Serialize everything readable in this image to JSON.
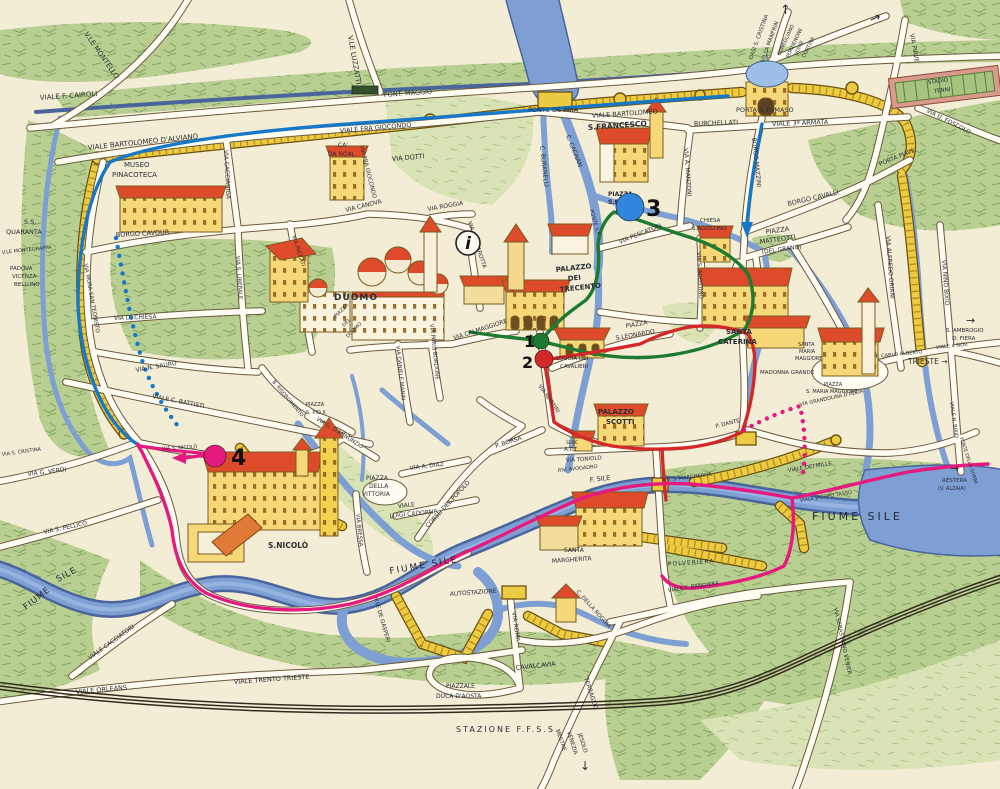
{
  "palette": {
    "paper": "#f3edd5",
    "water": "#7d9fd3",
    "water_dark": "#49659c",
    "green": "#b9cf92",
    "green_dark": "#5d8a3f",
    "wall_gold": "#ecca42",
    "wall_edge": "#6b500f",
    "road_fill": "#fffdf2",
    "road_edge": "#6a5a40",
    "building": "#f6d879",
    "roof_red": "#dd4b2b",
    "ink": "#2a2d33",
    "route_blue": "#1878c8",
    "route_green": "#1e7a30",
    "route_red": "#d42828",
    "route_pink": "#e6197e"
  },
  "info_marker": {
    "glyph": "i",
    "x": 468,
    "y": 243,
    "r": 12
  },
  "markers": [
    {
      "n": "1",
      "x": 541,
      "y": 341,
      "r": 8,
      "color": "#1e7a30",
      "tx": 524,
      "ty": 347,
      "ts": 16
    },
    {
      "n": "2",
      "x": 544,
      "y": 359,
      "r": 9,
      "color": "#d42828",
      "tx": 522,
      "ty": 368,
      "ts": 16
    },
    {
      "n": "3",
      "x": 630,
      "y": 207,
      "r": 14,
      "color": "#2f86dc",
      "tx": 646,
      "ty": 216,
      "ts": 22
    },
    {
      "n": "4",
      "x": 215,
      "y": 456,
      "r": 11,
      "color": "#e6197e",
      "tx": 231,
      "ty": 465,
      "ts": 22
    }
  ],
  "labels": [
    {
      "t": "V.LE MONTELLO",
      "x": 84,
      "y": 34,
      "r": 55,
      "s": 7
    },
    {
      "t": "VIALE F. CAIROLI",
      "x": 40,
      "y": 100,
      "r": -4,
      "s": 7
    },
    {
      "t": "PONT. MAGGIO",
      "x": 384,
      "y": 97,
      "r": -4,
      "s": 6.5
    },
    {
      "t": "V.LE LUZZATTI",
      "x": 348,
      "y": 36,
      "r": 80,
      "s": 7
    },
    {
      "t": "PONTE DE PRIA",
      "x": 528,
      "y": 112,
      "s": 6.5
    },
    {
      "t": "VIALE BARTOLOMEO  D'ALVIANO",
      "x": 88,
      "y": 150,
      "r": -6,
      "s": 7
    },
    {
      "t": "VIALE FRA GIOCONDO",
      "x": 340,
      "y": 133,
      "r": -5,
      "s": 6.5
    },
    {
      "t": "VIALE BARTOLOMEO",
      "x": 592,
      "y": 118,
      "r": -4,
      "s": 6.5
    },
    {
      "t": "BURCHELLATI",
      "x": 694,
      "y": 126,
      "r": -2,
      "s": 6.5
    },
    {
      "t": "VIALE 3ª ARMATA",
      "x": 772,
      "y": 126,
      "r": -2,
      "s": 6.5
    },
    {
      "t": "PORTA S.TOMASO",
      "x": 736,
      "y": 112,
      "s": 6.5,
      "n": "poi-porta-s-tomaso"
    },
    {
      "t": "OASI S. CRISTINA",
      "x": 752,
      "y": 60,
      "r": -70,
      "s": 5.5
    },
    {
      "t": "VILLA MANFRIN",
      "x": 764,
      "y": 62,
      "r": -70,
      "s": 5.5
    },
    {
      "t": "CONEGLIANO",
      "x": 780,
      "y": 56,
      "r": -65,
      "s": 5
    },
    {
      "t": "PORDENONE",
      "x": 789,
      "y": 58,
      "r": -65,
      "s": 5
    },
    {
      "t": "UDINE",
      "x": 797,
      "y": 56,
      "r": -65,
      "s": 5
    },
    {
      "t": "CORTINA",
      "x": 805,
      "y": 58,
      "r": -65,
      "s": 5
    },
    {
      "t": "↑",
      "x": 780,
      "y": 14,
      "s": 13,
      "n": "north-exit-arrow"
    },
    {
      "t": "→",
      "x": 872,
      "y": 24,
      "r": -25,
      "s": 13,
      "n": "east-exit-arrow"
    },
    {
      "t": "VIA PIAVE",
      "x": 910,
      "y": 34,
      "r": 80,
      "s": 6
    },
    {
      "t": "STADIO",
      "x": 928,
      "y": 84,
      "r": -7,
      "s": 5.5,
      "n": "poi-stadio-tenni"
    },
    {
      "t": "TENNI",
      "x": 934,
      "y": 93,
      "r": -7,
      "s": 5.5
    },
    {
      "t": "VIA U. FOSCOLO",
      "x": 926,
      "y": 112,
      "r": 27,
      "s": 6
    },
    {
      "t": "PORTA PIAVE",
      "x": 880,
      "y": 166,
      "r": -22,
      "s": 6
    },
    {
      "t": "BORGO CAVALLI",
      "x": 788,
      "y": 206,
      "r": -13,
      "s": 6.5
    },
    {
      "t": "BORGO MAZZINI",
      "x": 752,
      "y": 138,
      "r": 84,
      "s": 6
    },
    {
      "t": "VIA A. MANZONI",
      "x": 684,
      "y": 148,
      "r": 86,
      "s": 6
    },
    {
      "t": "S.FRANCESCO",
      "x": 588,
      "y": 130,
      "r": -4,
      "s": 7.5,
      "w": 1,
      "n": "poi-s-francesco"
    },
    {
      "t": "MUSEO",
      "x": 124,
      "y": 167,
      "s": 7,
      "n": "poi-museo-pinacoteca"
    },
    {
      "t": "PINACOTECA",
      "x": 112,
      "y": 177,
      "s": 7
    },
    {
      "t": "CA'",
      "x": 338,
      "y": 147,
      "s": 6
    },
    {
      "t": "DA NOAL",
      "x": 328,
      "y": 156,
      "s": 6
    },
    {
      "t": "VIA DOTTI",
      "x": 392,
      "y": 161,
      "r": -5,
      "s": 6.5
    },
    {
      "t": "VIA CACCIANIGA",
      "x": 224,
      "y": 150,
      "r": 87,
      "s": 6
    },
    {
      "t": "VIA FRA GIOCONDO",
      "x": 360,
      "y": 146,
      "r": 76,
      "s": 5.5
    },
    {
      "t": "C. CAGNAN",
      "x": 566,
      "y": 136,
      "r": 68,
      "s": 6
    },
    {
      "t": "C. BURANELLI",
      "x": 540,
      "y": 146,
      "r": 84,
      "s": 6
    },
    {
      "t": "PIAZZA",
      "x": 608,
      "y": 196,
      "s": 6,
      "w": 1
    },
    {
      "t": "S.FRANC.",
      "x": 608,
      "y": 204,
      "s": 6,
      "w": 1
    },
    {
      "t": "PONTE S.F.",
      "x": 590,
      "y": 210,
      "r": 75,
      "s": 5
    },
    {
      "t": "VIA PESCATORI",
      "x": 620,
      "y": 244,
      "r": -22,
      "s": 6
    },
    {
      "t": "CHIESA",
      "x": 700,
      "y": 222,
      "s": 5.5,
      "n": "poi-s-agostino"
    },
    {
      "t": "S.AGOSTINO",
      "x": 692,
      "y": 230,
      "s": 5.5
    },
    {
      "t": "PIAZZA",
      "x": 766,
      "y": 234,
      "r": -8,
      "s": 6.5
    },
    {
      "t": "MATTEOTTI",
      "x": 760,
      "y": 244,
      "r": -8,
      "s": 6.5
    },
    {
      "t": "(DEL GRANO)",
      "x": 762,
      "y": 254,
      "r": -8,
      "s": 6
    },
    {
      "t": "VIA S. AGOSTINO",
      "x": 697,
      "y": 252,
      "r": 87,
      "s": 5.5
    },
    {
      "t": "PALAZZO",
      "x": 556,
      "y": 272,
      "r": -6,
      "s": 7,
      "w": 1,
      "n": "poi-palazzo-dei-trecento"
    },
    {
      "t": "DEI",
      "x": 568,
      "y": 281,
      "r": -6,
      "s": 7,
      "w": 1
    },
    {
      "t": "TRECENTO",
      "x": 560,
      "y": 292,
      "r": -6,
      "s": 7,
      "w": 1
    },
    {
      "t": "DUOMO",
      "x": 334,
      "y": 300,
      "s": 9,
      "w": 1,
      "sp": 1,
      "n": "poi-duomo"
    },
    {
      "t": "PIAZZA",
      "x": 336,
      "y": 318,
      "r": -45,
      "s": 5
    },
    {
      "t": "DEL",
      "x": 344,
      "y": 327,
      "r": -45,
      "s": 5
    },
    {
      "t": "DUOMO",
      "x": 348,
      "y": 338,
      "r": -45,
      "s": 5
    },
    {
      "t": "VIA CANOVA",
      "x": 346,
      "y": 212,
      "r": -14,
      "s": 6
    },
    {
      "t": "VIA ROGGIA",
      "x": 428,
      "y": 211,
      "r": -10,
      "s": 6
    },
    {
      "t": "VIA CORNAROTTA",
      "x": 468,
      "y": 222,
      "r": 72,
      "s": 5.5
    },
    {
      "t": "VIA CALMAGGIORE",
      "x": 454,
      "y": 340,
      "r": -18,
      "s": 6
    },
    {
      "t": "VIA DANIELE MANIN",
      "x": 396,
      "y": 346,
      "r": 84,
      "s": 5.5
    },
    {
      "t": "VIA PARIS BORDONE",
      "x": 430,
      "y": 324,
      "r": 84,
      "s": 5.5
    },
    {
      "t": "VIA MARTIRI",
      "x": 538,
      "y": 386,
      "r": 55,
      "s": 5.5
    },
    {
      "t": "LOGGIA DEI",
      "x": 556,
      "y": 360,
      "s": 5.5,
      "n": "poi-loggia-dei-cavalieri"
    },
    {
      "t": "CAVALIERI",
      "x": 560,
      "y": 368,
      "s": 5.5
    },
    {
      "t": "PIAZZA",
      "x": 626,
      "y": 328,
      "r": -10,
      "s": 6
    },
    {
      "t": "S.LEONARDO",
      "x": 616,
      "y": 340,
      "r": -10,
      "s": 6
    },
    {
      "t": "SANTA",
      "x": 726,
      "y": 334,
      "s": 7,
      "w": 1,
      "n": "poi-santa-caterina"
    },
    {
      "t": "CATERINA",
      "x": 718,
      "y": 344,
      "s": 7,
      "w": 1
    },
    {
      "t": "SANTA",
      "x": 798,
      "y": 346,
      "s": 5,
      "n": "poi-santa-maria-maggiore"
    },
    {
      "t": "MARIA",
      "x": 799,
      "y": 353,
      "s": 5
    },
    {
      "t": "MAGGIORE",
      "x": 795,
      "y": 360,
      "s": 5
    },
    {
      "t": "MADONNA GRANDE",
      "x": 760,
      "y": 374,
      "s": 5.5
    },
    {
      "t": "PIAZZA",
      "x": 824,
      "y": 386,
      "s": 5
    },
    {
      "t": "S. MARIA MAGGIORE",
      "x": 806,
      "y": 393,
      "s": 5
    },
    {
      "t": "VIA GRANDOLINA D'ADDA",
      "x": 800,
      "y": 406,
      "r": -12,
      "s": 5
    },
    {
      "t": "VIA ALFREDO ORIANI",
      "x": 886,
      "y": 236,
      "r": 86,
      "s": 6
    },
    {
      "t": "VIA NINO BIXIO",
      "x": 942,
      "y": 260,
      "r": 86,
      "s": 6
    },
    {
      "t": "S. AMBROGIO",
      "x": 946,
      "y": 332,
      "s": 5.5
    },
    {
      "t": "D. FIERA",
      "x": 952,
      "y": 340,
      "s": 5.5
    },
    {
      "t": "→",
      "x": 966,
      "y": 324,
      "s": 11
    },
    {
      "t": "VIALE 4 NOV.",
      "x": 936,
      "y": 349,
      "r": -6,
      "s": 5
    },
    {
      "t": "P. CARLO ALBERTO",
      "x": 876,
      "y": 358,
      "r": -6,
      "s": 5
    },
    {
      "t": "TRIESTE →",
      "x": 908,
      "y": 364,
      "s": 7.5
    },
    {
      "t": "PALAZZO",
      "x": 598,
      "y": 414,
      "s": 7,
      "w": 1,
      "n": "poi-palazzo-scotti"
    },
    {
      "t": "SCOTTI",
      "x": 606,
      "y": 424,
      "s": 7,
      "w": 1
    },
    {
      "t": "SEDE",
      "x": 566,
      "y": 444,
      "s": 4.5,
      "n": "poi-sede-apt"
    },
    {
      "t": "A.P.T.",
      "x": 564,
      "y": 451,
      "s": 5.5
    },
    {
      "t": "VIA TONIOLO",
      "x": 566,
      "y": 462,
      "r": -4,
      "s": 5.5
    },
    {
      "t": "RIV. AVOGADRO",
      "x": 558,
      "y": 472,
      "r": -6,
      "s": 5
    },
    {
      "t": "P. BORSA",
      "x": 496,
      "y": 448,
      "r": -18,
      "s": 6
    },
    {
      "t": "VIA G. D'ANNUNZIO",
      "x": 316,
      "y": 420,
      "r": 32,
      "s": 5.5
    },
    {
      "t": "B. RISORGIMENTO",
      "x": 272,
      "y": 382,
      "r": 50,
      "s": 5
    },
    {
      "t": "PIAZZA",
      "x": 306,
      "y": 406,
      "s": 5
    },
    {
      "t": "S. PIO X",
      "x": 306,
      "y": 414,
      "s": 5
    },
    {
      "t": "VIA A. DIAZ",
      "x": 410,
      "y": 470,
      "r": -7,
      "s": 6
    },
    {
      "t": "PIAZZA",
      "x": 366,
      "y": 480,
      "s": 6
    },
    {
      "t": "DELLA",
      "x": 369,
      "y": 488,
      "s": 6
    },
    {
      "t": "VITTORIA",
      "x": 362,
      "y": 496,
      "s": 6
    },
    {
      "t": "VIALE",
      "x": 398,
      "y": 508,
      "r": -6,
      "s": 6
    },
    {
      "t": "LUIGI CADORNA",
      "x": 390,
      "y": 518,
      "r": -6,
      "s": 6
    },
    {
      "t": "VIA BRESSA",
      "x": 356,
      "y": 514,
      "r": 84,
      "s": 5.5
    },
    {
      "t": "CORSO DEL POPOLO",
      "x": 428,
      "y": 528,
      "r": -47,
      "s": 6
    },
    {
      "t": "FIUME SILE",
      "x": 390,
      "y": 574,
      "r": -10,
      "s": 9,
      "sp": 2,
      "c": "#23283d",
      "n": "river-label"
    },
    {
      "t": "FIUME",
      "x": 26,
      "y": 610,
      "r": -38,
      "s": 8.5,
      "sp": 1,
      "c": "#23283d",
      "n": "river-label"
    },
    {
      "t": "SILE",
      "x": 58,
      "y": 582,
      "r": -28,
      "s": 8.5,
      "sp": 1,
      "c": "#23283d"
    },
    {
      "t": "F. SILE",
      "x": 590,
      "y": 482,
      "r": -6,
      "s": 6.5,
      "c": "#23283d"
    },
    {
      "t": "FIUME   SILE",
      "x": 812,
      "y": 520,
      "s": 11,
      "sp": 3,
      "c": "#23283d",
      "n": "river-label"
    },
    {
      "t": "S.NICOLÒ",
      "x": 268,
      "y": 548,
      "s": 7.5,
      "w": 1,
      "n": "poi-s-nicolo"
    },
    {
      "t": "VIA S. NICOLÒ",
      "x": 162,
      "y": 450,
      "r": -3,
      "s": 5
    },
    {
      "t": "S.S.",
      "x": 24,
      "y": 224,
      "s": 6.5,
      "n": "poi-ss-quaranta"
    },
    {
      "t": "QUARANTA",
      "x": 6,
      "y": 234,
      "s": 6.5
    },
    {
      "t": "V.LE MONTEGRAPPA",
      "x": 2,
      "y": 254,
      "r": -6,
      "s": 5
    },
    {
      "t": "PADOVA",
      "x": 10,
      "y": 270,
      "s": 5.5
    },
    {
      "t": "VICENZA",
      "x": 12,
      "y": 278,
      "s": 5.5
    },
    {
      "t": "BELLUNO",
      "x": 14,
      "y": 286,
      "s": 5.5
    },
    {
      "t": "BORGO CAVOUR",
      "x": 116,
      "y": 237,
      "r": -3,
      "s": 6.5
    },
    {
      "t": "VIA MURA SAN TEONISTO",
      "x": 84,
      "y": 264,
      "r": 80,
      "s": 5.5
    },
    {
      "t": "VIA S. LIBERALE",
      "x": 236,
      "y": 256,
      "r": 86,
      "s": 5.5
    },
    {
      "t": "VIA RICCATI",
      "x": 292,
      "y": 236,
      "r": 72,
      "s": 5.5
    },
    {
      "t": "VIA D. CHIESA",
      "x": 114,
      "y": 320,
      "r": -2,
      "s": 6
    },
    {
      "t": "VIA N. SAURO",
      "x": 136,
      "y": 372,
      "r": -10,
      "s": 6
    },
    {
      "t": "VIALE C. BATTISTI",
      "x": 152,
      "y": 398,
      "r": 11,
      "s": 6
    },
    {
      "t": "VIA S. CRISTINA",
      "x": 2,
      "y": 456,
      "r": -8,
      "s": 5
    },
    {
      "t": "VIA G. VERDI",
      "x": 28,
      "y": 476,
      "r": -7,
      "s": 6
    },
    {
      "t": "VIA S. PELLICO",
      "x": 44,
      "y": 534,
      "r": -12,
      "s": 6
    },
    {
      "t": "AUTOSTAZIONE",
      "x": 450,
      "y": 596,
      "r": -4,
      "s": 6
    },
    {
      "t": "SANTA",
      "x": 564,
      "y": 552,
      "s": 6,
      "n": "poi-santa-margherita"
    },
    {
      "t": "MARGHERITA",
      "x": 552,
      "y": 563,
      "r": -4,
      "s": 6
    },
    {
      "t": "POLVERIERA",
      "x": 668,
      "y": 566,
      "r": -4,
      "s": 6,
      "sp": 1
    },
    {
      "t": "RIV. S. MARGHERITA",
      "x": 662,
      "y": 482,
      "r": -7,
      "s": 5
    },
    {
      "t": "P. DANTE",
      "x": 716,
      "y": 428,
      "r": -14,
      "s": 5.5
    },
    {
      "t": "VIALE DEI MILLE",
      "x": 788,
      "y": 472,
      "r": -9,
      "s": 5.5
    },
    {
      "t": "VIALE JACOPO TASSO",
      "x": 800,
      "y": 502,
      "r": -9,
      "s": 5
    },
    {
      "t": "RESTERA",
      "x": 942,
      "y": 482,
      "s": 5.5
    },
    {
      "t": "(V. ALZAIA)",
      "x": 938,
      "y": 490,
      "s": 5
    },
    {
      "t": "→",
      "x": 950,
      "y": 472,
      "s": 11
    },
    {
      "t": "PONTE DELLA GOBBA",
      "x": 960,
      "y": 438,
      "r": 72,
      "s": 4.5
    },
    {
      "t": "VIALE N. BIXIO",
      "x": 950,
      "y": 402,
      "r": 82,
      "s": 5
    },
    {
      "t": "VIALE F. BANDIERA",
      "x": 668,
      "y": 592,
      "r": -8,
      "s": 5.5
    },
    {
      "t": "VIA SEBASTIANO VENIER",
      "x": 834,
      "y": 608,
      "r": 78,
      "s": 5.5
    },
    {
      "t": "VIA ROMA",
      "x": 512,
      "y": 612,
      "r": 82,
      "s": 6
    },
    {
      "t": "CAVALCAVIA",
      "x": 516,
      "y": 670,
      "r": -6,
      "s": 6.5
    },
    {
      "t": "PIAZZALE",
      "x": 446,
      "y": 688,
      "s": 6
    },
    {
      "t": "DUCA D'AOSTA",
      "x": 436,
      "y": 698,
      "s": 6
    },
    {
      "t": "STAZIONE F.F.S.S.",
      "x": 456,
      "y": 732,
      "s": 8,
      "sp": 2,
      "n": "poi-stazione"
    },
    {
      "t": "TERRAGLIO",
      "x": 584,
      "y": 678,
      "r": 72,
      "s": 6
    },
    {
      "t": "MESTRE",
      "x": 556,
      "y": 730,
      "r": 72,
      "s": 5.5
    },
    {
      "t": "VENEZIA",
      "x": 567,
      "y": 732,
      "r": 72,
      "s": 5.5
    },
    {
      "t": "JESOLO",
      "x": 578,
      "y": 734,
      "r": 72,
      "s": 5.5
    },
    {
      "t": "↓",
      "x": 580,
      "y": 770,
      "s": 12
    },
    {
      "t": "VIALE CACCIATORI",
      "x": 90,
      "y": 660,
      "r": -36,
      "s": 6
    },
    {
      "t": "VIALE ORLEANS",
      "x": 76,
      "y": 694,
      "r": -5,
      "s": 6.5
    },
    {
      "t": "VIALE TRENTO TRIESTE",
      "x": 234,
      "y": 684,
      "r": -4,
      "s": 6.5
    },
    {
      "t": "V.LE DE GASPERI",
      "x": 374,
      "y": 598,
      "r": 74,
      "s": 5.5
    },
    {
      "t": "C. DELLA ROGGIA",
      "x": 576,
      "y": 592,
      "r": 48,
      "s": 5.5
    }
  ]
}
